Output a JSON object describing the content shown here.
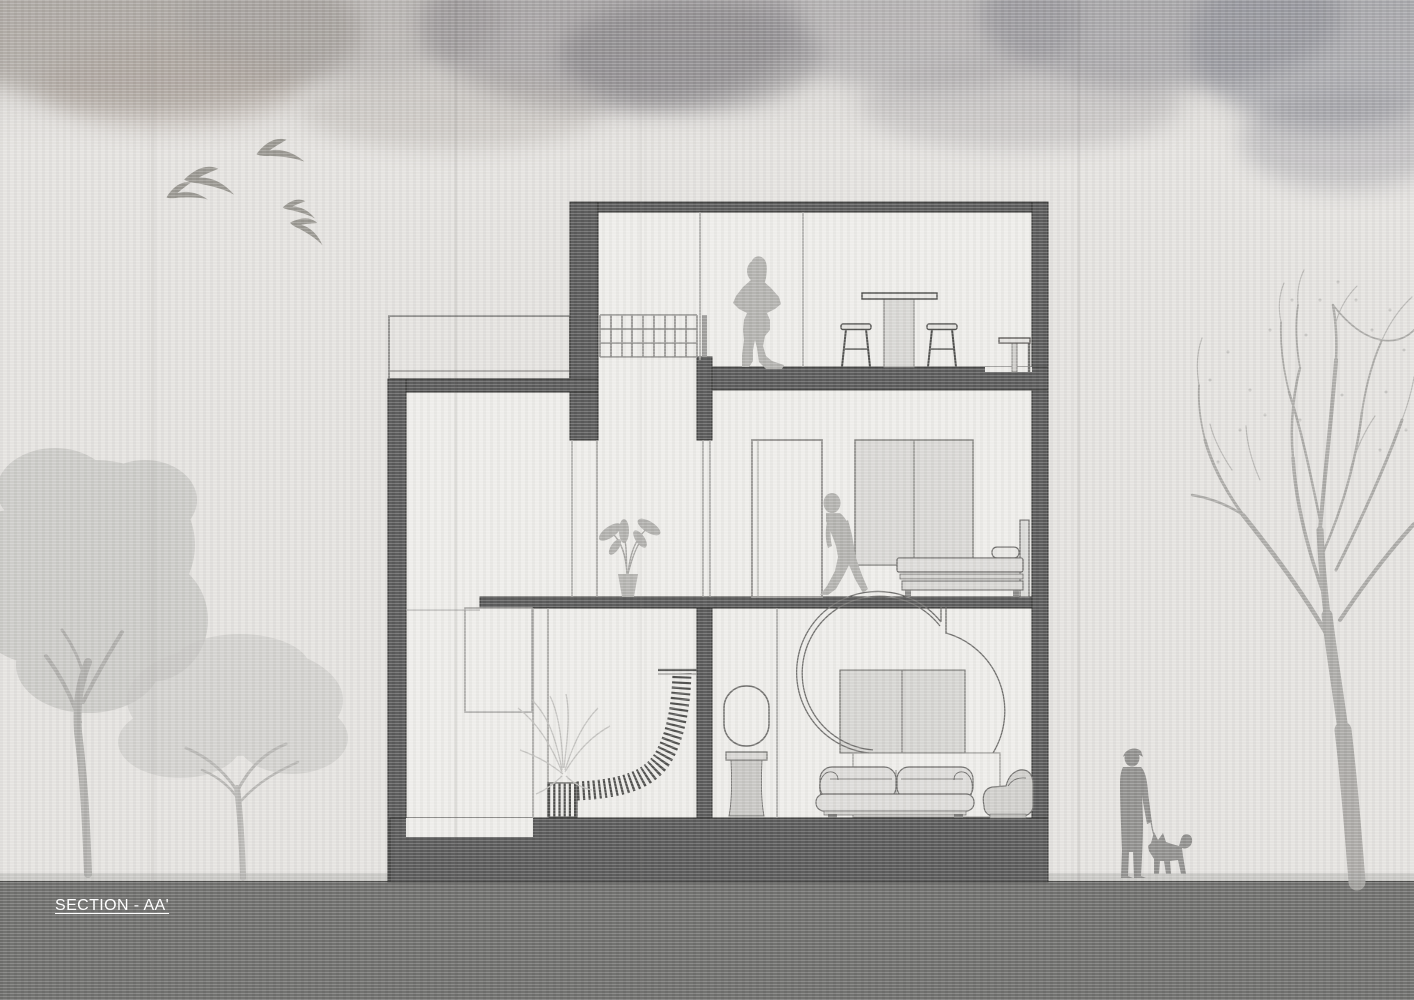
{
  "title": {
    "label": "SECTION - AA'"
  },
  "colors": {
    "paper": "#e4e2df",
    "wall": "#585858",
    "wall_outline": "#2d2d2c",
    "interior": "#edece9",
    "line": "#a3a2a0",
    "grid": "#8d8c8a",
    "furniture_fill": "#dcdbd8",
    "furniture_stroke": "#6f6e6c",
    "occupant": "#b2b1ae",
    "entourage": "#8f8e8c",
    "bird": "#97958f",
    "tree_light": "#b9b8b5",
    "tree_lighter": "#c7c6c3",
    "branch": "#a4a3a0",
    "ground": "#6c6c6a",
    "ground_edge": "#c9c8c5",
    "title_text": "#ffffff"
  },
  "scene": {
    "type": "architectural-section-drawing",
    "building": {
      "floors": [
        {
          "id": "second-floor",
          "items": [
            "cube-shelf",
            "standing-woman",
            "bar-table",
            "stool",
            "stool",
            "side-table"
          ]
        },
        {
          "id": "first-floor",
          "items": [
            "terrace-parapet",
            "potted-plant",
            "door",
            "walking-man",
            "wardrobe",
            "bed"
          ]
        },
        {
          "id": "ground-floor",
          "items": [
            "closet",
            "palm-plant",
            "curved-stair",
            "slatted-bench",
            "oval-mirror",
            "pedestal-basin",
            "arched-alcove",
            "cabinet",
            "sofa",
            "armchair"
          ]
        }
      ]
    },
    "surroundings": {
      "birds": 5,
      "left_trees": 2,
      "right_bare_tree": 1,
      "pedestrian": "man-walking-dog"
    }
  }
}
